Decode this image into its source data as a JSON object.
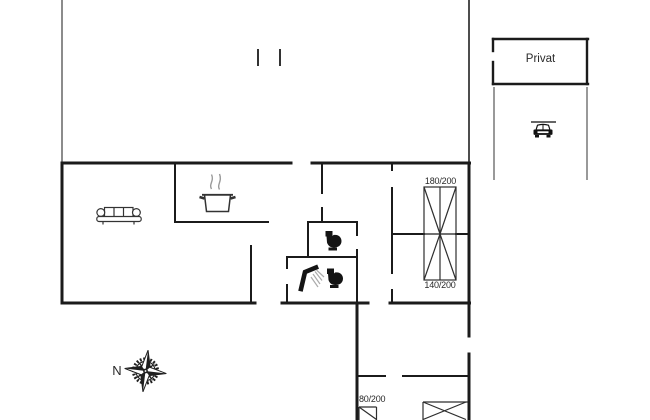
{
  "plan": {
    "background": "#ffffff",
    "wall_color": "#1b1b1b",
    "boundary_color": "#4f4f4f",
    "text_color": "#2a2a2a",
    "labels": {
      "garage": "Privat",
      "compass_north": "N"
    },
    "bed_labels": {
      "double_top": "180/200",
      "double_bottom": "140/200",
      "single": "80/200"
    },
    "icons": [
      {
        "name": "sofa-icon",
        "meaning": "sofa in living room"
      },
      {
        "name": "cooking-pot-icon",
        "meaning": "kitchen / stove"
      },
      {
        "name": "toilet-icon",
        "meaning": "toilet room"
      },
      {
        "name": "shower-icon",
        "meaning": "bathroom shower"
      },
      {
        "name": "toilet-icon",
        "meaning": "bathroom toilet"
      },
      {
        "name": "car-icon",
        "meaning": "parking / carport"
      },
      {
        "name": "compass-rose-icon",
        "meaning": "north direction"
      }
    ]
  }
}
